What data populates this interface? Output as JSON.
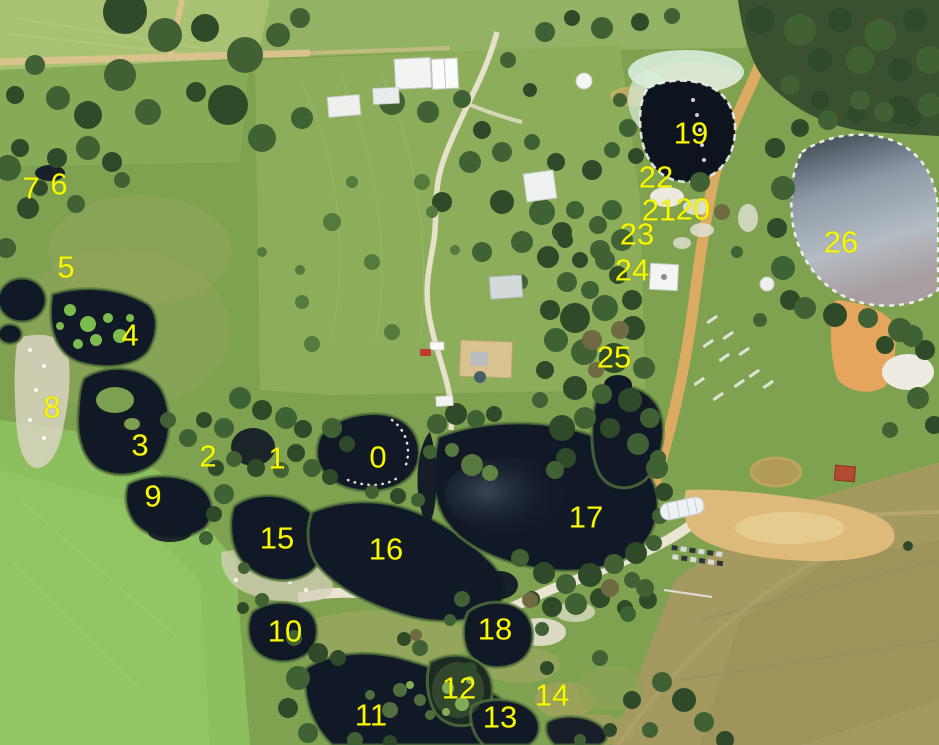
{
  "canvas": {
    "width": 939,
    "height": 745
  },
  "scene": {
    "type": "aerial-photograph",
    "subject": "rural property with ponds and dams numbered in yellow"
  },
  "colors": {
    "label": "#f8f800",
    "water_dark": "#121926",
    "pond26_water": "#9aa4ae",
    "grass": "#7fa251",
    "bright_field": "#8cc05e",
    "olive_field": "#a49a60",
    "forest": "#3a512f",
    "sand_road": "#dcab62",
    "gravel_road": "#e7e0cb"
  },
  "markers": [
    {
      "text": "0",
      "x": 378,
      "y": 458
    },
    {
      "text": "1",
      "x": 277,
      "y": 459
    },
    {
      "text": "2",
      "x": 208,
      "y": 457
    },
    {
      "text": "3",
      "x": 140,
      "y": 446
    },
    {
      "text": "4",
      "x": 130,
      "y": 336
    },
    {
      "text": "5",
      "x": 66,
      "y": 268
    },
    {
      "text": "6",
      "x": 59,
      "y": 185
    },
    {
      "text": "7",
      "x": 31,
      "y": 189
    },
    {
      "text": "8",
      "x": 52,
      "y": 408
    },
    {
      "text": "9",
      "x": 153,
      "y": 497
    },
    {
      "text": "10",
      "x": 285,
      "y": 632
    },
    {
      "text": "11",
      "x": 371,
      "y": 716
    },
    {
      "text": "12",
      "x": 459,
      "y": 689
    },
    {
      "text": "13",
      "x": 500,
      "y": 718
    },
    {
      "text": "14",
      "x": 552,
      "y": 696
    },
    {
      "text": "15",
      "x": 277,
      "y": 539
    },
    {
      "text": "16",
      "x": 386,
      "y": 550
    },
    {
      "text": "17",
      "x": 586,
      "y": 518
    },
    {
      "text": "18",
      "x": 495,
      "y": 630
    },
    {
      "text": "19",
      "x": 691,
      "y": 134
    },
    {
      "text": "20",
      "x": 693,
      "y": 210
    },
    {
      "text": "21",
      "x": 659,
      "y": 211
    },
    {
      "text": "22",
      "x": 656,
      "y": 178
    },
    {
      "text": "23",
      "x": 637,
      "y": 235
    },
    {
      "text": "24",
      "x": 632,
      "y": 271
    },
    {
      "text": "25",
      "x": 614,
      "y": 358
    },
    {
      "text": "26",
      "x": 841,
      "y": 243
    }
  ]
}
